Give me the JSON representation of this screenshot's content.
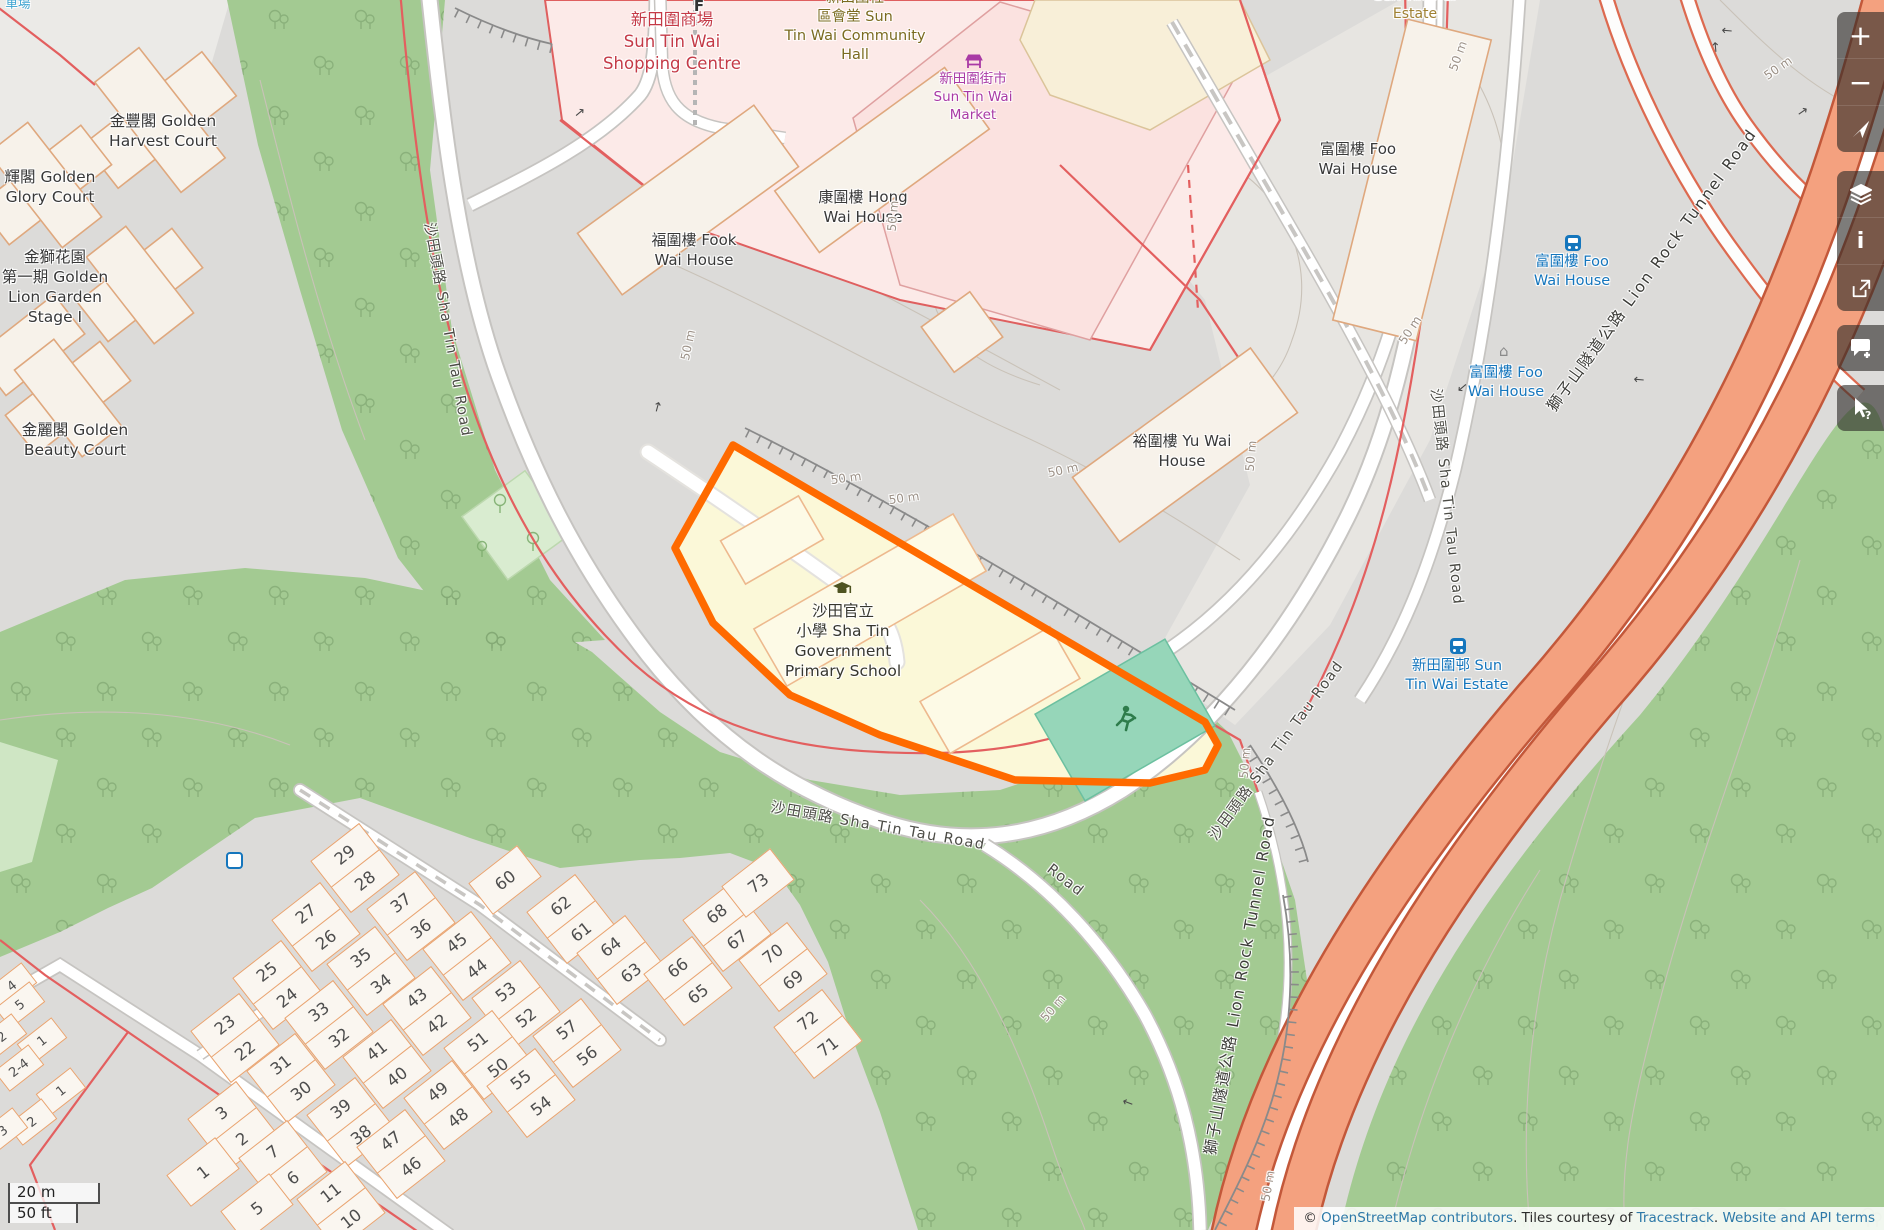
{
  "map": {
    "palette": {
      "highlight_orange": "#ff6a00",
      "forest_green": "#a3ca92",
      "highway_salmon": "#f4a17f",
      "retail_pink": "#fceae8",
      "school_yellow": "#fbf8d8",
      "pitch_teal": "#96d6b9",
      "transit_blue": "#1576bd",
      "retail_label_red": "#c43a47",
      "market_purple": "#a93aa5",
      "estate_brown": "#9f8133",
      "hall_olive": "#7b6b20"
    },
    "controls": [
      {
        "name": "zoom-in",
        "glyph": "+"
      },
      {
        "name": "zoom-out",
        "glyph": "−"
      },
      {
        "name": "locate",
        "glyph": ""
      },
      {
        "name": "layers",
        "glyph": ""
      },
      {
        "name": "map-info",
        "glyph": "i"
      },
      {
        "name": "share",
        "glyph": ""
      },
      {
        "name": "add-note",
        "glyph": ""
      },
      {
        "name": "query-features",
        "glyph": "?"
      }
    ],
    "scale": {
      "metric": "20 m",
      "imperial": "50 ft"
    },
    "attribution": {
      "copyright": "© ",
      "link_osm": "OpenStreetMap contributors",
      "mid1": ". Tiles courtesy of ",
      "link_tiles": "Tracestrack",
      "mid2": ". ",
      "link_terms": "Website and API terms"
    },
    "icons": [
      {
        "name": "parking-icon",
        "x": 234,
        "y": 861
      },
      {
        "name": "bus-stop-icon",
        "x": 1573,
        "y": 243
      },
      {
        "name": "bus-stop-icon",
        "x": 1458,
        "y": 646
      },
      {
        "name": "shelter-icon",
        "x": 1506,
        "y": 350
      }
    ],
    "labels": [
      {
        "name": "parking-label-fragment",
        "x": 18,
        "y": 3,
        "size": 12.5,
        "color": "#3ba3d0",
        "lines": [
          "車場"
        ]
      },
      {
        "name": "golden-harvest-court",
        "x": 163,
        "y": 131,
        "size": 15.5,
        "color": "#383838",
        "lines": [
          "金豐閣 Golden",
          "Harvest Court"
        ]
      },
      {
        "name": "golden-glory-court",
        "x": 50,
        "y": 187,
        "size": 15.5,
        "color": "#383838",
        "lines": [
          "輝閣 Golden",
          "Glory Court"
        ]
      },
      {
        "name": "golden-lion-garden",
        "x": 55,
        "y": 287,
        "size": 15.5,
        "color": "#383838",
        "lines": [
          "金獅花園",
          "第一期 Golden",
          "Lion Garden",
          "Stage I"
        ]
      },
      {
        "name": "golden-beauty-court",
        "x": 75,
        "y": 440,
        "size": 15.5,
        "color": "#383838",
        "lines": [
          "金麗閣 Golden",
          "Beauty Court"
        ]
      },
      {
        "name": "sun-tin-wai-shopping-centre",
        "x": 672,
        "y": 42,
        "size": 16.5,
        "color": "#c43a47",
        "lines": [
          "新田圍商場",
          "Sun Tin Wai",
          "Shopping Centre"
        ]
      },
      {
        "name": "sun-tin-wai-community-hall",
        "x": 855,
        "y": 27,
        "size": 14.5,
        "color": "#7b6b20",
        "lines": [
          "新田圍社",
          "區會堂 Sun",
          "Tin Wai Community",
          "Hall"
        ]
      },
      {
        "name": "sun-tin-wai-market",
        "x": 973,
        "y": 97,
        "size": 13.5,
        "color": "#a93aa5",
        "lines": [
          "新田圍街市",
          "Sun Tin Wai",
          "Market"
        ]
      },
      {
        "name": "hong-wai-house",
        "x": 863,
        "y": 207,
        "size": 15,
        "color": "#383838",
        "lines": [
          "康圍樓 Hong",
          "Wai House"
        ]
      },
      {
        "name": "fook-wai-house",
        "x": 694,
        "y": 250,
        "size": 15,
        "color": "#383838",
        "lines": [
          "福圍樓 Fook",
          "Wai House"
        ]
      },
      {
        "name": "foo-wai-house",
        "x": 1358,
        "y": 159,
        "size": 15,
        "color": "#383838",
        "lines": [
          "富圍樓 Foo",
          "Wai House"
        ]
      },
      {
        "name": "yu-wai-house",
        "x": 1182,
        "y": 451,
        "size": 15,
        "color": "#383838",
        "lines": [
          "裕圍樓 Yu Wai",
          "House"
        ]
      },
      {
        "name": "sun-tin-wai-estate",
        "x": 1415,
        "y": 5,
        "size": 14,
        "color": "#9f8133",
        "lines": [
          "Sun Tin Wai",
          "Estate"
        ]
      },
      {
        "name": "foo-wai-house-stop-upper",
        "x": 1572,
        "y": 272,
        "size": 14.5,
        "color": "#1576bd",
        "lines": [
          "富圍樓 Foo",
          "Wai House"
        ]
      },
      {
        "name": "foo-wai-house-stop-lower",
        "x": 1506,
        "y": 383,
        "size": 14.5,
        "color": "#1576bd",
        "lines": [
          "富圍樓 Foo",
          "Wai House"
        ]
      },
      {
        "name": "sun-tin-wai-estate-stop",
        "x": 1457,
        "y": 676,
        "size": 14.5,
        "color": "#1576bd",
        "lines": [
          "新田圍邨 Sun",
          "Tin Wai Estate"
        ]
      },
      {
        "name": "school-label",
        "x": 843,
        "y": 641,
        "size": 15.5,
        "color": "#37372e",
        "lines": [
          "沙田官立",
          "小學 Sha Tin",
          "Government",
          "Primary School"
        ]
      },
      {
        "name": "fitness-label-fragment",
        "x": 699,
        "y": 6,
        "size": 15,
        "color": "#333333",
        "bold": true,
        "lines": [
          "F"
        ]
      },
      {
        "name": "sha-tin-tau-road-upper",
        "x": 447,
        "y": 330,
        "rot": 80,
        "size": 14.5,
        "color": "#4c4c46",
        "ls": 1.5,
        "lines": [
          "沙田頭路 Sha Tin Tau Road"
        ]
      },
      {
        "name": "sha-tin-tau-road-lower",
        "x": 878,
        "y": 827,
        "rot": 10,
        "size": 14.5,
        "color": "#4c4c46",
        "ls": 1.5,
        "lines": [
          "沙田頭路 Sha Tin Tau Road"
        ]
      },
      {
        "name": "road-fragment",
        "x": 1065,
        "y": 881,
        "rot": 38,
        "size": 14.5,
        "color": "#4c4c46",
        "ls": 1.5,
        "lines": [
          "Road"
        ]
      },
      {
        "name": "sha-tin-tau-road-branch",
        "x": 1277,
        "y": 751,
        "rot": -54,
        "size": 14.5,
        "color": "#4c4c46",
        "ls": 1.5,
        "lines": [
          "沙田頭路 Sha Tin Tau Road"
        ]
      },
      {
        "name": "sha-tin-tau-road-vertical",
        "x": 1446,
        "y": 497,
        "rot": 84,
        "size": 14.5,
        "color": "#4c4c46",
        "ls": 1.5,
        "lines": [
          "沙田頭路 Sha Tin Tau Road"
        ]
      },
      {
        "name": "lion-rock-tunnel-road-upper",
        "x": 1652,
        "y": 270,
        "rot": -54,
        "size": 15.5,
        "color": "#3c3c38",
        "ls": 2,
        "lines": [
          "獅子山隧道公路 Lion Rock Tunnel Road"
        ]
      },
      {
        "name": "lion-rock-tunnel-road-lower",
        "x": 1240,
        "y": 985,
        "rot": -80,
        "size": 15.5,
        "color": "#3c3c38",
        "ls": 2,
        "lines": [
          "獅子山隧道公路 Lion Rock Tunnel Road"
        ]
      },
      {
        "name": "contour-label",
        "x": 688,
        "y": 345,
        "rot": -78,
        "size": 12,
        "color": "#9c9187",
        "lines": [
          "50 m"
        ]
      },
      {
        "name": "contour-label",
        "x": 893,
        "y": 216,
        "rot": -85,
        "size": 12,
        "color": "#9c9187",
        "lines": [
          "50 m"
        ]
      },
      {
        "name": "contour-label",
        "x": 846,
        "y": 478,
        "rot": -8,
        "size": 12,
        "color": "#9c9187",
        "lines": [
          "50 m"
        ]
      },
      {
        "name": "contour-label",
        "x": 904,
        "y": 498,
        "rot": -8,
        "size": 12,
        "color": "#9c9187",
        "lines": [
          "50 m"
        ]
      },
      {
        "name": "contour-label",
        "x": 1063,
        "y": 470,
        "rot": -12,
        "size": 12,
        "color": "#9c9187",
        "lines": [
          "50 m"
        ]
      },
      {
        "name": "contour-label",
        "x": 1251,
        "y": 456,
        "rot": -85,
        "size": 12,
        "color": "#9c9187",
        "lines": [
          "50 m"
        ]
      },
      {
        "name": "contour-label",
        "x": 1410,
        "y": 330,
        "rot": -57,
        "size": 12,
        "color": "#9c9187",
        "lines": [
          "50 m"
        ]
      },
      {
        "name": "contour-label",
        "x": 1458,
        "y": 56,
        "rot": -70,
        "size": 12,
        "color": "#9c9187",
        "lines": [
          "50 m"
        ]
      },
      {
        "name": "contour-label",
        "x": 1778,
        "y": 68,
        "rot": -35,
        "size": 12,
        "color": "#9c9187",
        "lines": [
          "50 m"
        ]
      },
      {
        "name": "contour-label",
        "x": 1245,
        "y": 763,
        "rot": -85,
        "size": 12,
        "color": "#9c9187",
        "lines": [
          "50 m"
        ]
      },
      {
        "name": "contour-label",
        "x": 1268,
        "y": 1186,
        "rot": -80,
        "size": 12,
        "color": "#9c9187",
        "lines": [
          "50 m"
        ]
      },
      {
        "name": "contour-label",
        "x": 1053,
        "y": 1008,
        "rot": -50,
        "size": 12,
        "color": "#9c9187",
        "lines": [
          "50 m"
        ]
      }
    ],
    "oneway_arrows": [
      {
        "x": 580,
        "y": 113,
        "rot": -40
      },
      {
        "x": 658,
        "y": 407,
        "rot": -75
      },
      {
        "x": 1462,
        "y": 387,
        "rot": 140
      },
      {
        "x": 1727,
        "y": 30,
        "rot": 185
      },
      {
        "x": 1716,
        "y": 47,
        "rot": -95
      },
      {
        "x": 1803,
        "y": 112,
        "rot": -35
      },
      {
        "x": 1639,
        "y": 379,
        "rot": 185
      },
      {
        "x": 1128,
        "y": 1102,
        "rot": 200
      }
    ],
    "house_blocks": [
      {
        "x": 355,
        "y": 868,
        "cells": [
          "29",
          "28"
        ]
      },
      {
        "x": 316,
        "y": 927,
        "cells": [
          "27",
          "26"
        ]
      },
      {
        "x": 277,
        "y": 985,
        "cells": [
          "25",
          "24"
        ]
      },
      {
        "x": 235,
        "y": 1038,
        "cells": [
          "23",
          "22"
        ]
      },
      {
        "x": 411,
        "y": 916,
        "cells": [
          "37",
          "36"
        ]
      },
      {
        "x": 371,
        "y": 971,
        "cells": [
          "35",
          "34"
        ]
      },
      {
        "x": 329,
        "y": 1025,
        "cells": [
          "33",
          "32"
        ]
      },
      {
        "x": 291,
        "y": 1078,
        "cells": [
          "31",
          "30"
        ]
      },
      {
        "x": 505,
        "y": 880,
        "cells": [
          "60"
        ]
      },
      {
        "x": 467,
        "y": 956,
        "cells": [
          "45",
          "44"
        ]
      },
      {
        "x": 427,
        "y": 1011,
        "cells": [
          "43",
          "42"
        ]
      },
      {
        "x": 387,
        "y": 1064,
        "cells": [
          "41",
          "40"
        ]
      },
      {
        "x": 351,
        "y": 1122,
        "cells": [
          "39",
          "38"
        ]
      },
      {
        "x": 571,
        "y": 919,
        "cells": [
          "62",
          "61"
        ]
      },
      {
        "x": 621,
        "y": 960,
        "cells": [
          "64",
          "63"
        ]
      },
      {
        "x": 688,
        "y": 981,
        "cells": [
          "66",
          "65"
        ]
      },
      {
        "x": 727,
        "y": 927,
        "cells": [
          "68",
          "67"
        ]
      },
      {
        "x": 758,
        "y": 883,
        "cells": [
          "73"
        ]
      },
      {
        "x": 783,
        "y": 967,
        "cells": [
          "70",
          "69"
        ]
      },
      {
        "x": 818,
        "y": 1034,
        "cells": [
          "72",
          "71"
        ]
      },
      {
        "x": 516,
        "y": 1005,
        "cells": [
          "53",
          "52"
        ]
      },
      {
        "x": 488,
        "y": 1055,
        "cells": [
          "51",
          "50"
        ]
      },
      {
        "x": 448,
        "y": 1105,
        "cells": [
          "49",
          "48"
        ]
      },
      {
        "x": 401,
        "y": 1154,
        "cells": [
          "47",
          "46"
        ]
      },
      {
        "x": 531,
        "y": 1093,
        "cells": [
          "55",
          "54"
        ]
      },
      {
        "x": 577,
        "y": 1043,
        "cells": [
          "57",
          "56"
        ]
      },
      {
        "x": 232,
        "y": 1126,
        "cells": [
          "3",
          "2"
        ]
      },
      {
        "x": 203,
        "y": 1172,
        "cells": [
          "1"
        ]
      },
      {
        "x": 283,
        "y": 1165,
        "cells": [
          "7",
          "6"
        ]
      },
      {
        "x": 257,
        "y": 1208,
        "cells": [
          "5"
        ]
      },
      {
        "x": 341,
        "y": 1206,
        "cells": [
          "11",
          "10"
        ]
      },
      {
        "x": 12,
        "y": 986,
        "small": true,
        "cells": [
          "4"
        ]
      },
      {
        "x": 20,
        "y": 1005,
        "small": true,
        "cells": [
          "5"
        ]
      },
      {
        "x": 2,
        "y": 1037,
        "small": true,
        "cells": [
          "2"
        ]
      },
      {
        "x": 42,
        "y": 1041,
        "small": true,
        "cells": [
          "1"
        ]
      },
      {
        "x": 19,
        "y": 1068,
        "small": true,
        "cells": [
          "2-4"
        ]
      },
      {
        "x": 61,
        "y": 1091,
        "small": true,
        "cells": [
          "1"
        ]
      },
      {
        "x": 32,
        "y": 1122,
        "small": true,
        "cells": [
          "2"
        ]
      },
      {
        "x": 3,
        "y": 1131,
        "small": true,
        "cells": [
          "3"
        ]
      }
    ]
  }
}
